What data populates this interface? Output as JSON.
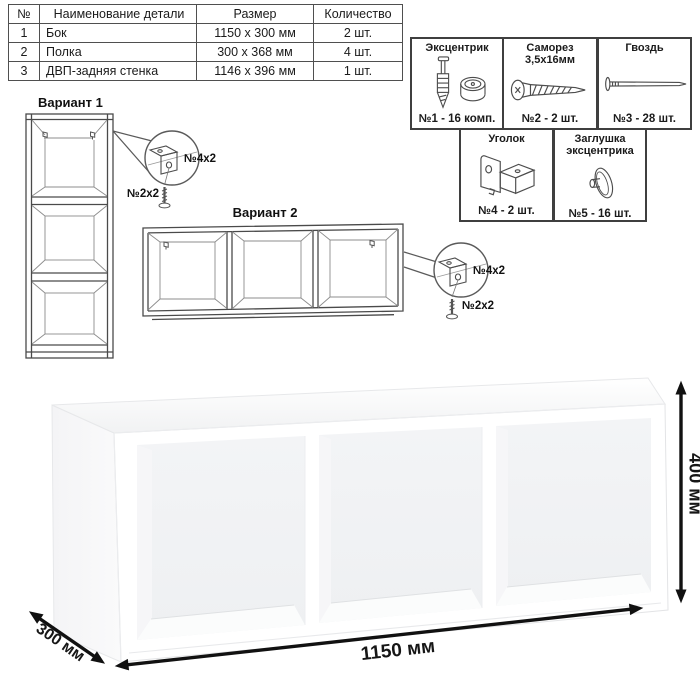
{
  "parts_table": {
    "col_headers": [
      "№",
      "Наименование детали",
      "Размер",
      "Количество"
    ],
    "rows": [
      {
        "num": "1",
        "name": "Бок",
        "size": "1150 x 300 мм",
        "qty": "2 шт."
      },
      {
        "num": "2",
        "name": "Полка",
        "size": "300 x 368 мм",
        "qty": "4 шт."
      },
      {
        "num": "3",
        "name": "ДВП-задняя стенка",
        "size": "1146 x 396 мм",
        "qty": "1 шт."
      }
    ]
  },
  "hardware_box": {
    "items": [
      {
        "title": "Эксцентрик",
        "count": "№1 - 16 комп.",
        "icon": "eccentric-cam-and-bolt"
      },
      {
        "title": "Саморез 3,5х16мм",
        "count": "№2 - 2 шт.",
        "icon": "screw"
      },
      {
        "title": "Гвоздь",
        "count": "№3 - 28 шт.",
        "icon": "nail"
      },
      {
        "title": "Уголок",
        "count": "№4 - 2 шт.",
        "icon": "corner-bracket"
      },
      {
        "title": "Заглушка эксцентрика",
        "count": "№5 - 16 шт.",
        "icon": "cam-cover-cap"
      }
    ]
  },
  "variants": {
    "v1": {
      "title": "Вариант 1",
      "bracket_label": "№4х2",
      "screw_label": "№2х2"
    },
    "v2": {
      "title": "Вариант 2",
      "bracket_label": "№4х2",
      "screw_label": "№2х2"
    }
  },
  "dimensions": {
    "width": "1150 мм",
    "height": "400 мм",
    "depth": "300 мм"
  }
}
